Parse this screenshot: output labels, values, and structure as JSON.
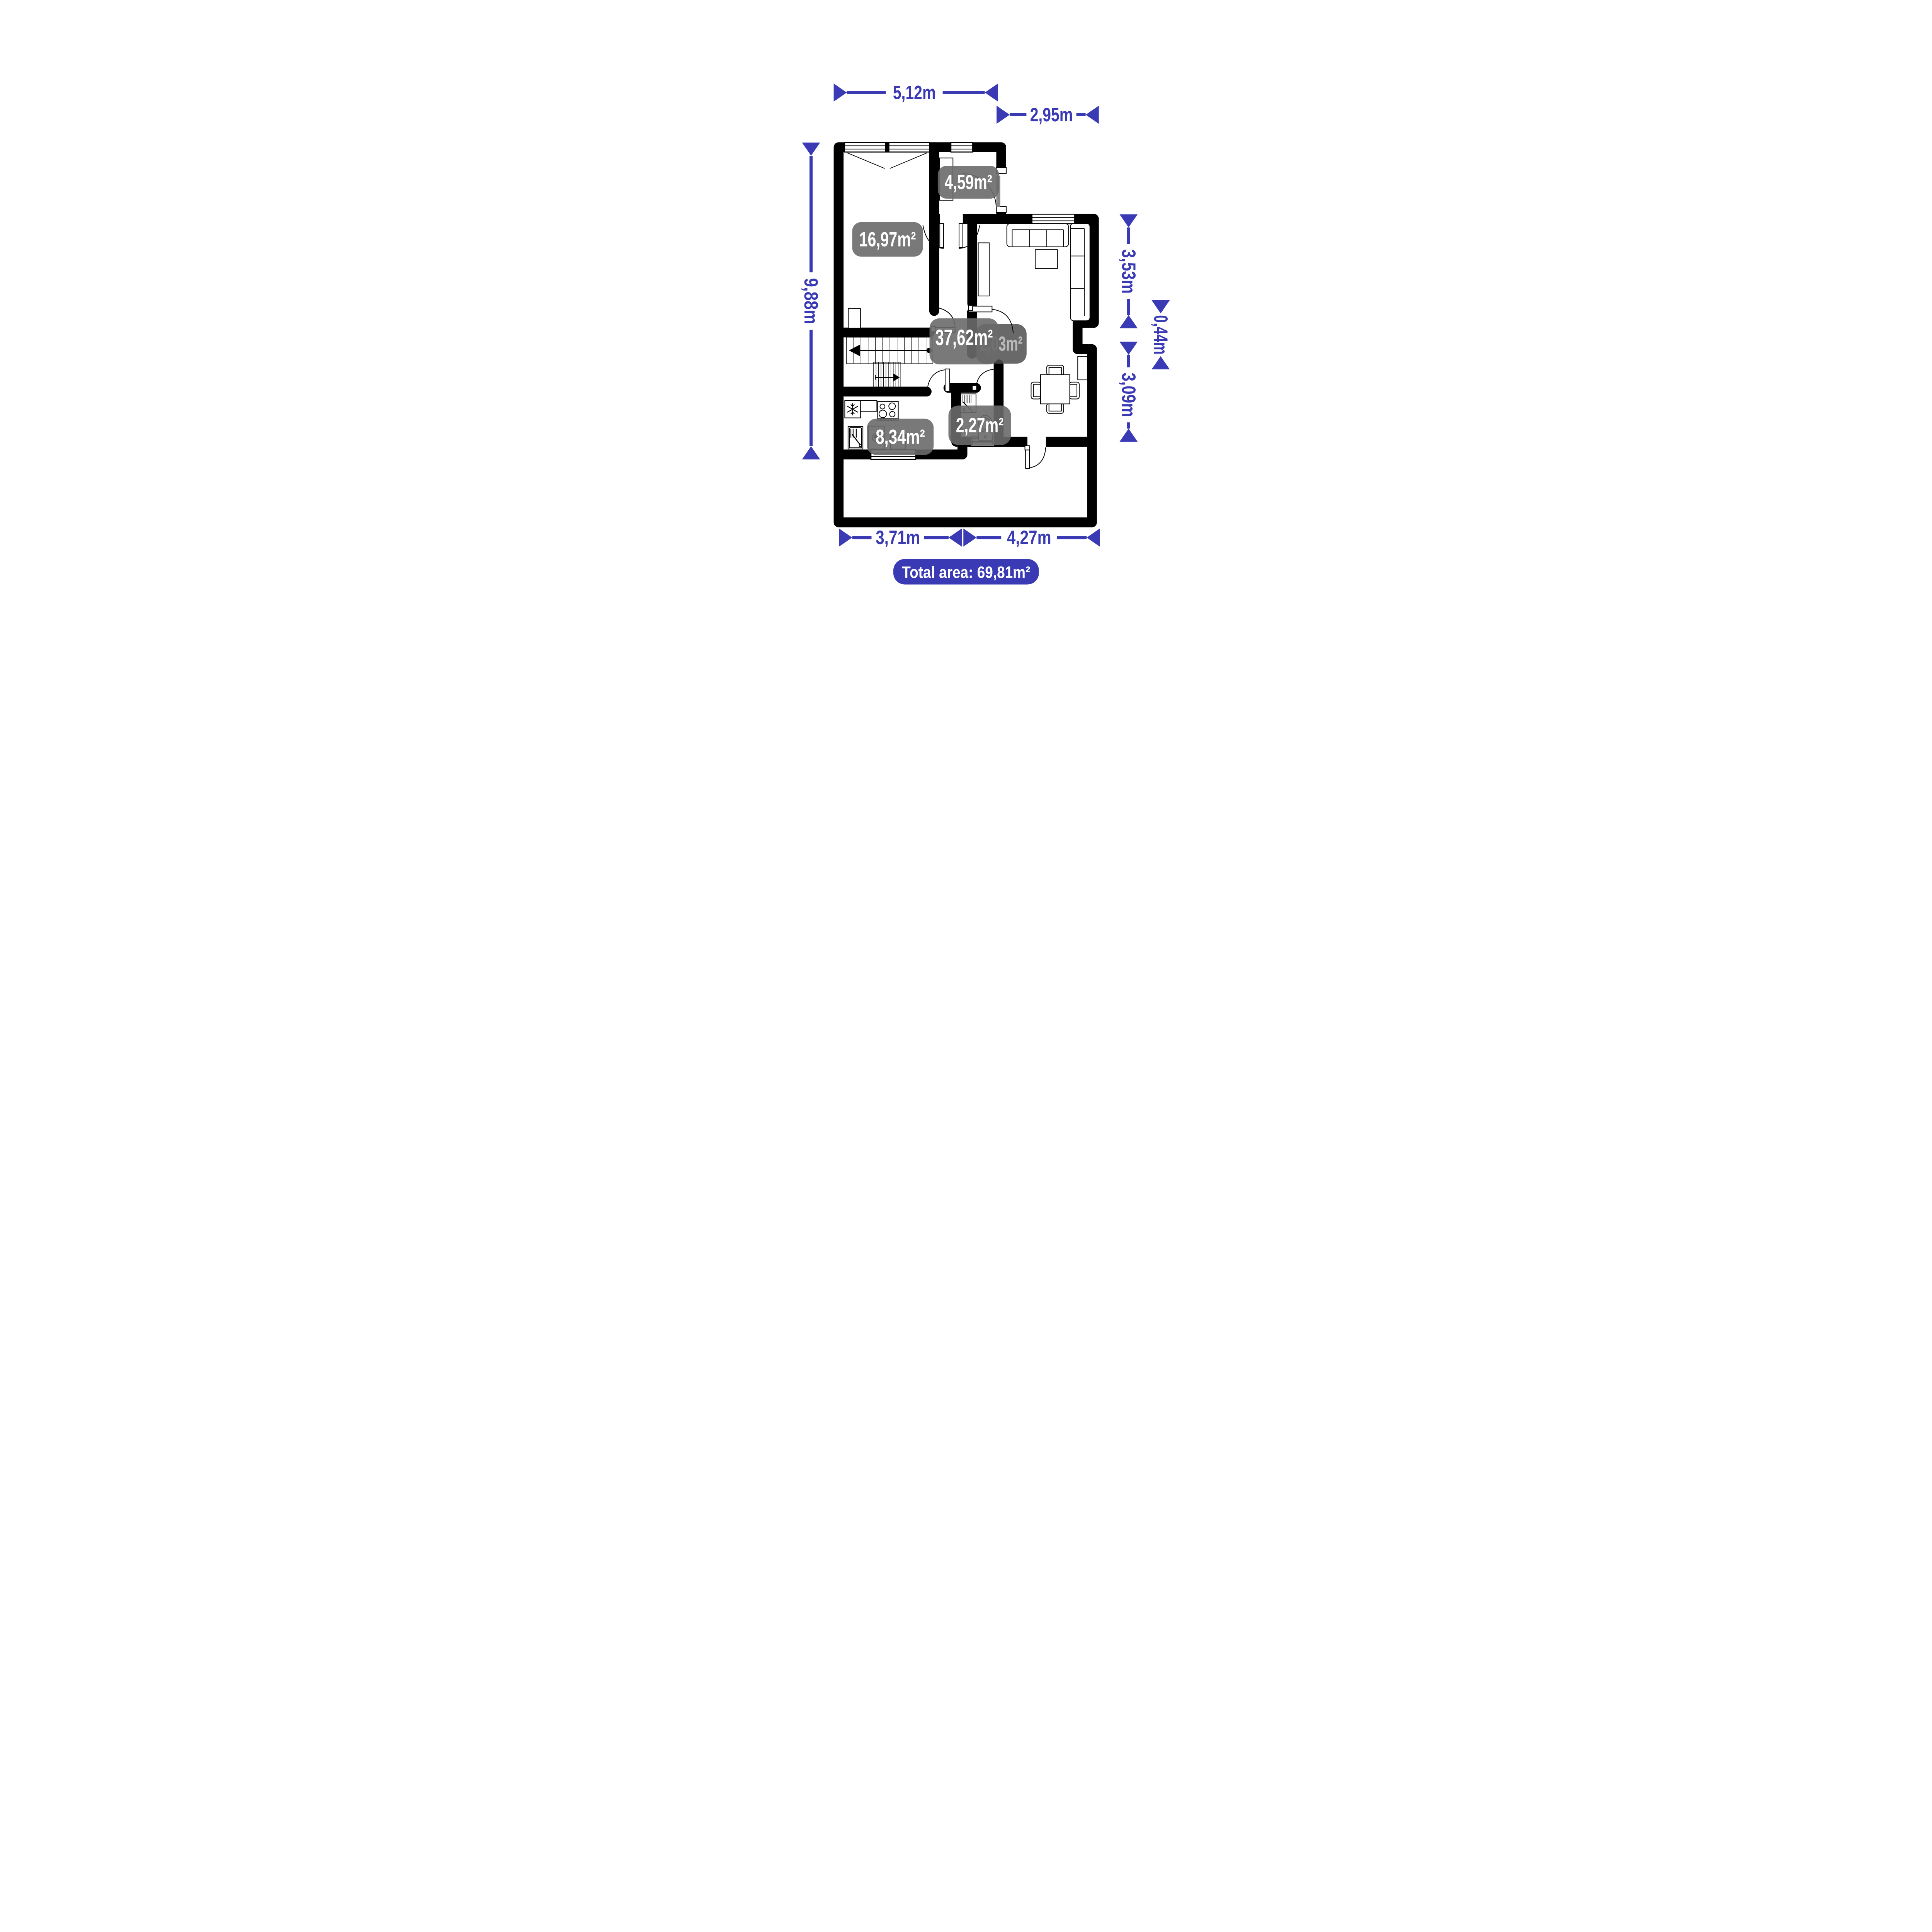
{
  "colors": {
    "accent_blue": "#3a3ab5",
    "wall_black": "#000000",
    "room_label_gray": "#6a6a6a",
    "hidden_label_gray": "#4f4f4f",
    "door_leaf_gray": "#8a8a8a",
    "label_text_white": "#ffffff"
  },
  "dimensions": {
    "top_width": "5,12m",
    "entry_width": "2,95m",
    "left_height": "9,88m",
    "right_upper": "3,53m",
    "right_niche": "0,44m",
    "right_lower": "3,09m",
    "bottom_left": "3,71m",
    "bottom_right": "4,27m"
  },
  "rooms": {
    "bedroom": "16,97m²",
    "hallway": "4,59m²",
    "living": "37,62m²",
    "hidden": "2,03m²",
    "kitchen": "8,34m²",
    "bathroom": "2,27m²"
  },
  "footer": {
    "total_area": "Total area: 69,81m²"
  },
  "icons": [
    "freezer-snowflake-icon",
    "heater-waves-icon",
    "stair-direction-arrow-icon",
    "door-swing-arc-icon",
    "window-symbol-icon",
    "dimension-arrow-icon"
  ]
}
